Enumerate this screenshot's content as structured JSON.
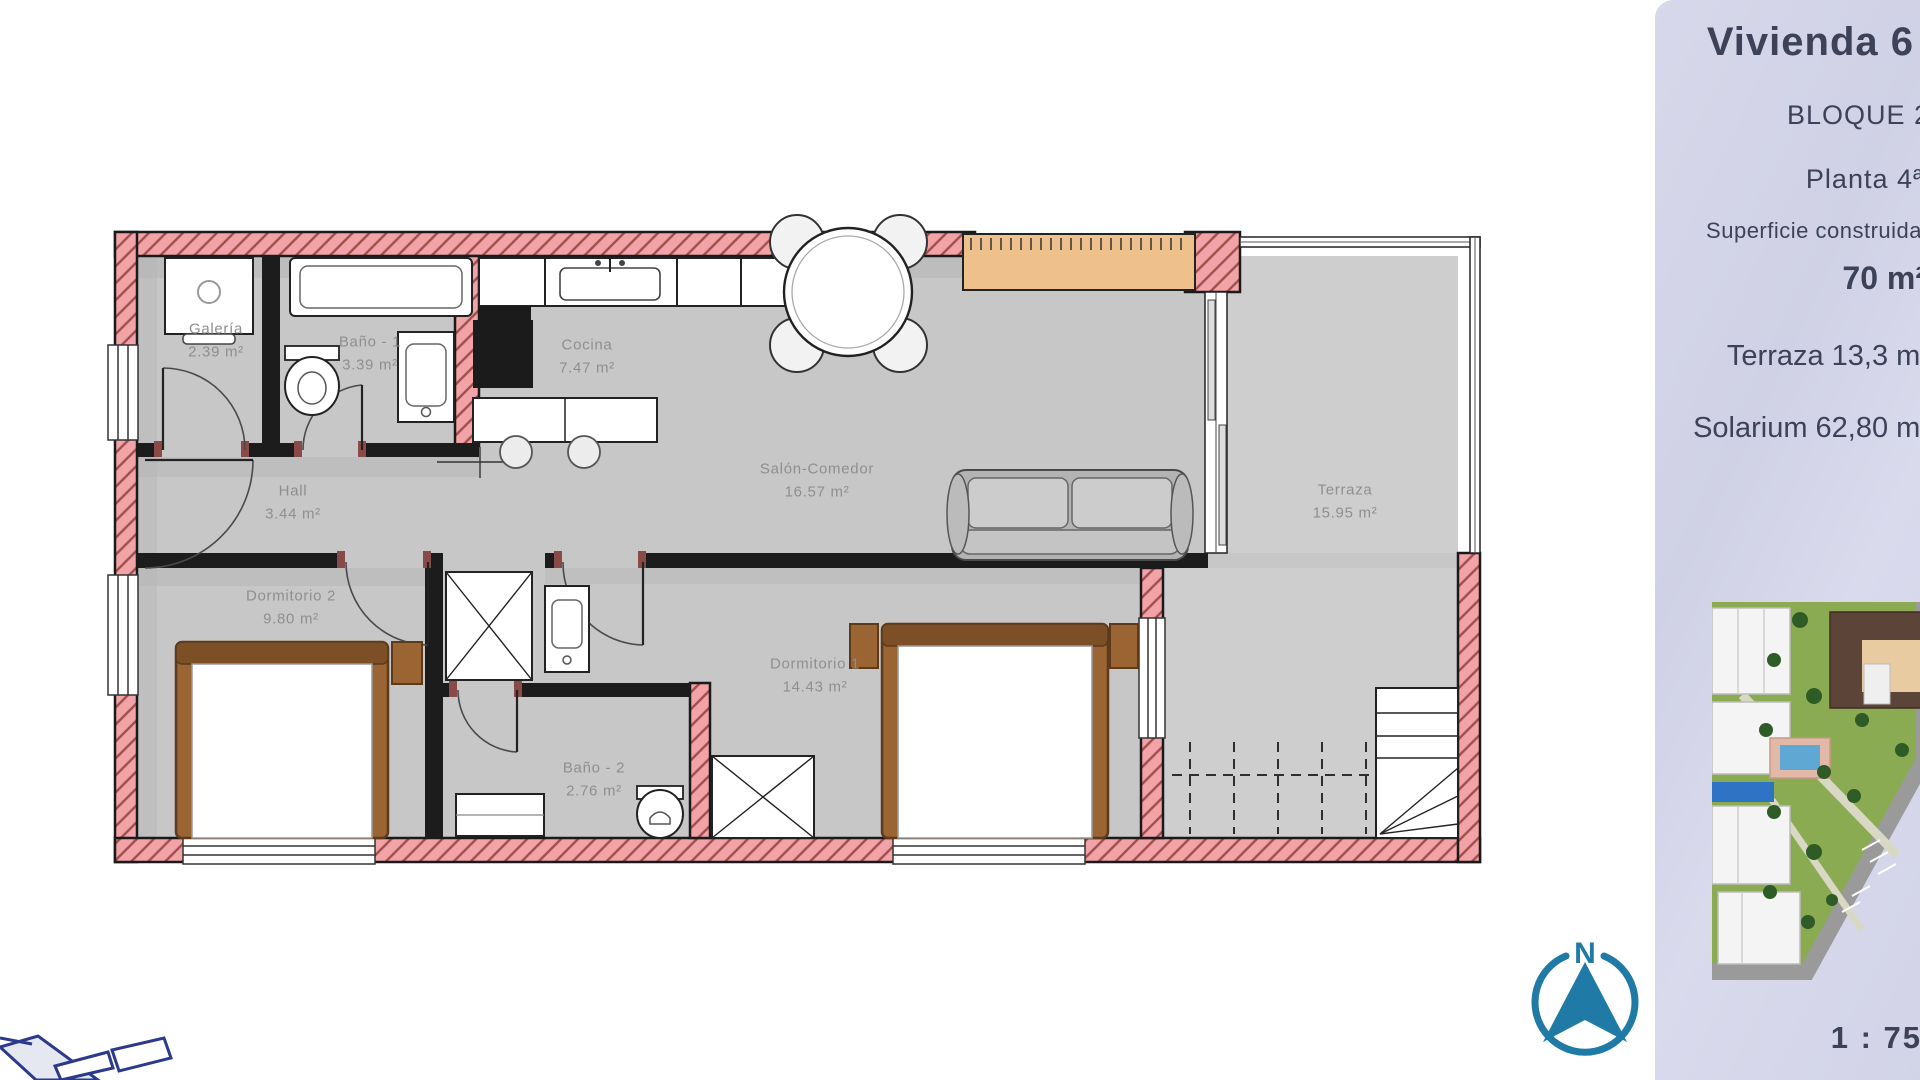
{
  "plan": {
    "rooms": [
      {
        "name": "Galería",
        "area": "2.39 m²"
      },
      {
        "name": "Baño - 1",
        "area": "3.39 m²"
      },
      {
        "name": "Cocina",
        "area": "7.47 m²"
      },
      {
        "name": "Salón-Comedor",
        "area": "16.57 m²"
      },
      {
        "name": "Hall",
        "area": "3.44 m²"
      },
      {
        "name": "Dormitorio 2",
        "area": "9.80 m²"
      },
      {
        "name": "Dormitorio 1",
        "area": "14.43 m²"
      },
      {
        "name": "Baño - 2",
        "area": "2.76 m²"
      },
      {
        "name": "Terraza",
        "area": "15.95 m²"
      }
    ],
    "colors": {
      "wall_fill": "#f2a3a8",
      "wall_hatch": "#a04e4b",
      "floor": "#c7c7c7",
      "wood": "#9a6433",
      "canopy": "#eec08b"
    }
  },
  "sidebar": {
    "title": "Vivienda 6",
    "block": "BLOQUE 2",
    "floor": "Planta 4ª",
    "area_label": "Superficie construida",
    "area_value": "70 m²",
    "terrace": "Terraza 13,3 m²",
    "solarium": "Solarium 62,80 m²",
    "scale": "1 : 75",
    "bg_color": "#d4d5e8",
    "text_color": "#3d4258",
    "marker_color": "#2e73c4"
  },
  "compass": {
    "label": "N",
    "color": "#1f7aa6"
  }
}
